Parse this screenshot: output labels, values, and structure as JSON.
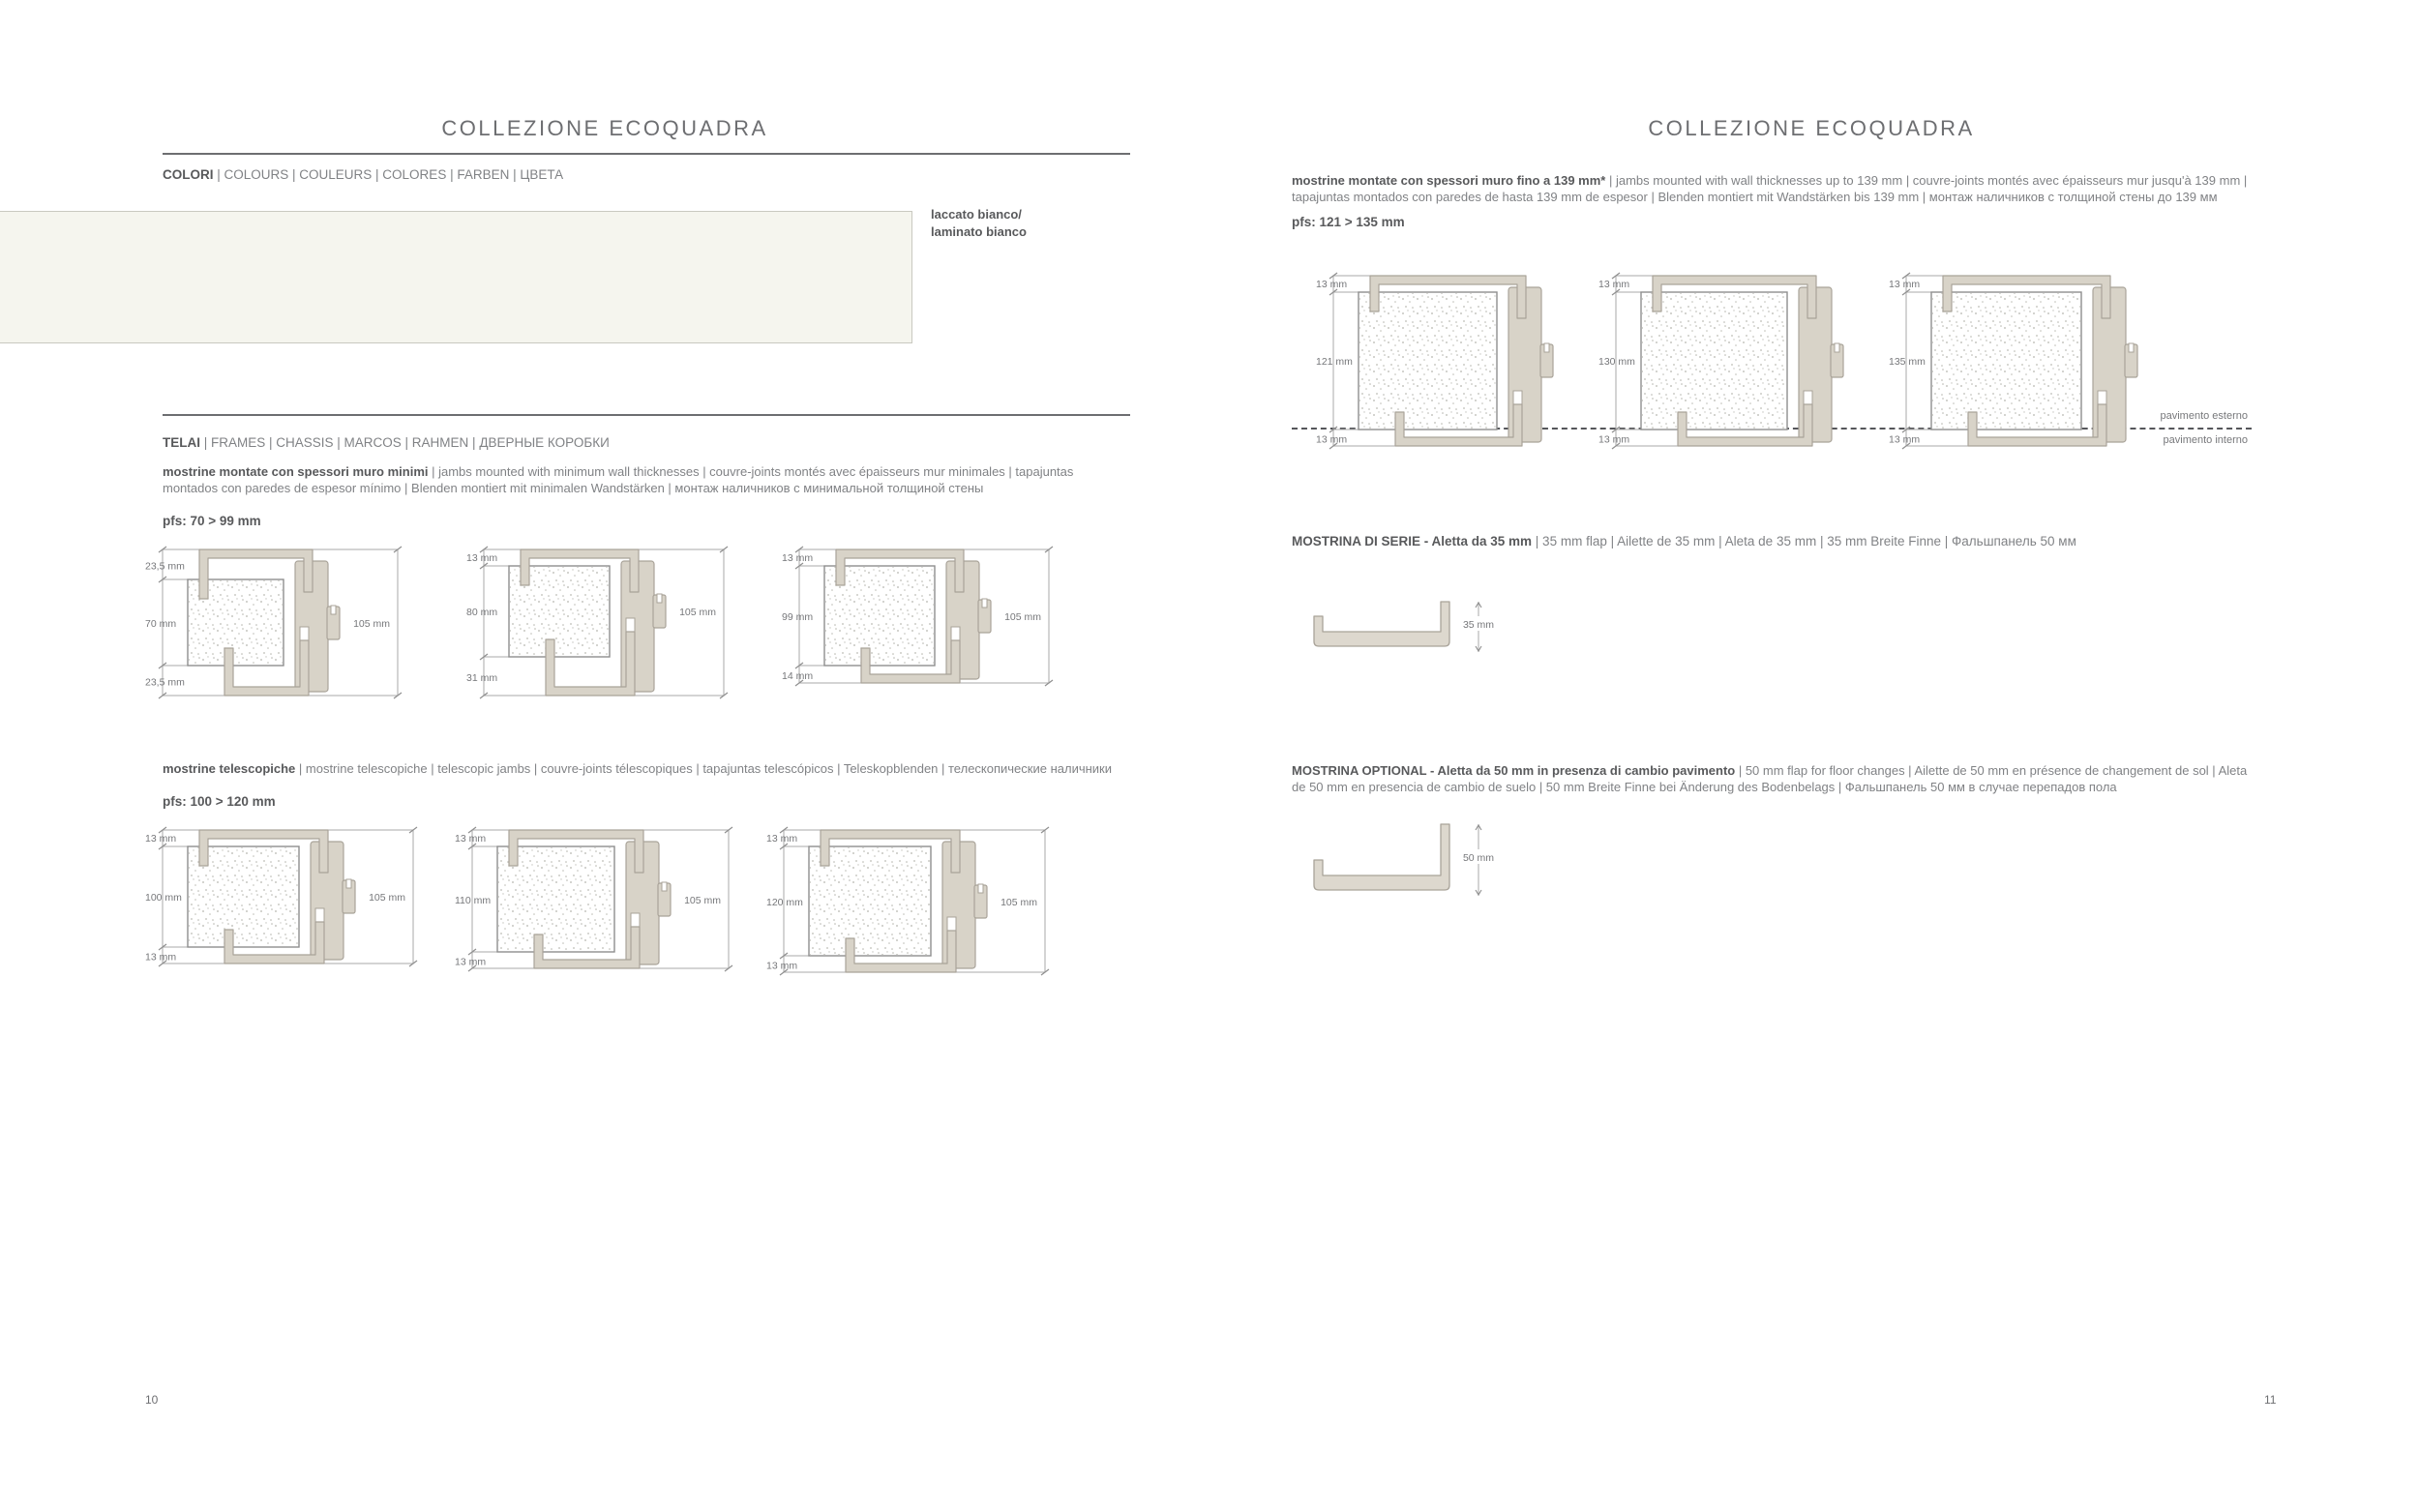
{
  "colors": {
    "text_dark": "#58595b",
    "text_light": "#808285",
    "beige_fill": "#d8d3c8",
    "beige_outline": "#a9a399",
    "swatch_fill": "#f5f5ee",
    "dim_line": "#aaaaaa",
    "dim_text": "#76777a"
  },
  "page_left": {
    "title": "COLLEZIONE ECOQUADRA",
    "page_number": "10",
    "colors_section": {
      "heading_lead": "COLORI",
      "heading_tail": " | COLOURS | COULEURS | COLORES | FARBEN | ЦВЕТА",
      "swatch_label_line1": "laccato bianco/",
      "swatch_label_line2": "laminato bianco"
    },
    "frames_section": {
      "heading_lead": "TELAI",
      "heading_tail": " | FRAMES | CHASSIS | MARCOS | RAHMEN | ДВЕРНЫЕ КОРОБКИ",
      "groups": [
        {
          "desc_lead": "mostrine montate con spessori muro minimi",
          "desc_tail": " | jambs mounted with minimum wall thicknesses | couvre-joints montés avec épaisseurs mur minimales | tapajuntas montados con paredes de espesor mínimo | Blenden montiert mit minimalen Wandstärken | монтаж наличников с минимальной толщиной стены",
          "pfs": "pfs: 70 > 99 mm",
          "diagrams": [
            {
              "top": "23,5 mm",
              "left": "70 mm",
              "bottom": "23,5 mm",
              "right": "105 mm"
            },
            {
              "top": "13 mm",
              "left": "80 mm",
              "bottom": "31 mm",
              "right": "105 mm"
            },
            {
              "top": "13 mm",
              "left": "99 mm",
              "bottom": "14 mm",
              "right": "105 mm"
            }
          ]
        },
        {
          "desc_lead": "mostrine telescopiche",
          "desc_tail": " | mostrine telescopiche | telescopic jambs | couvre-joints télescopiques | tapajuntas telescópicos | Teleskopblenden | телескопические наличники",
          "pfs": "pfs: 100 > 120 mm",
          "diagrams": [
            {
              "top": "13 mm",
              "left": "100 mm",
              "bottom": "13 mm",
              "right": "105 mm"
            },
            {
              "top": "13 mm",
              "left": "110 mm",
              "bottom": "13 mm",
              "right": "105 mm"
            },
            {
              "top": "13 mm",
              "left": "120 mm",
              "bottom": "13 mm",
              "right": "105 mm"
            }
          ]
        }
      ]
    }
  },
  "page_right": {
    "title": "COLLEZIONE ECOQUADRA",
    "page_number": "11",
    "intro": {
      "desc_lead": "mostrine montate con spessori muro fino a 139 mm*",
      "desc_tail": " | jambs mounted with wall thicknesses up to 139 mm | couvre-joints montés avec épaisseurs mur jusqu'à 139 mm | tapajuntas montados con paredes de hasta 139 mm de espesor | Blenden montiert mit Wandstärken bis 139 mm | монтаж наличников с толщиной стены до 139 мм",
      "pfs": "pfs: 121 > 135 mm",
      "diagrams": [
        {
          "top": "13 mm",
          "left": "121 mm",
          "bottom": "13 mm"
        },
        {
          "top": "13 mm",
          "left": "130 mm",
          "bottom": "13 mm"
        },
        {
          "top": "13 mm",
          "left": "135 mm",
          "bottom": "13 mm"
        }
      ],
      "floor_label_above": "pavimento esterno",
      "floor_label_below": "pavimento interno"
    },
    "mostrina_serie": {
      "heading_lead": "MOSTRINA DI SERIE - Aletta da 35 mm",
      "heading_tail": " | 35 mm flap | Ailette de 35 mm | Aleta de 35 mm | 35 mm Breite Finne | Фальшпанель 50 мм",
      "dim": "35 mm"
    },
    "mostrina_optional": {
      "heading_lead": "MOSTRINA OPTIONAL - Aletta da 50 mm in presenza di cambio pavimento",
      "heading_tail": " | 50 mm flap for floor changes | Ailette de 50 mm en présence de changement de sol | Aleta de 50 mm en presencia de cambio de suelo | 50 mm Breite Finne bei Änderung des Bodenbelags | Фальшпанель 50 мм в случае перепадов пола",
      "dim": "50 mm"
    }
  }
}
